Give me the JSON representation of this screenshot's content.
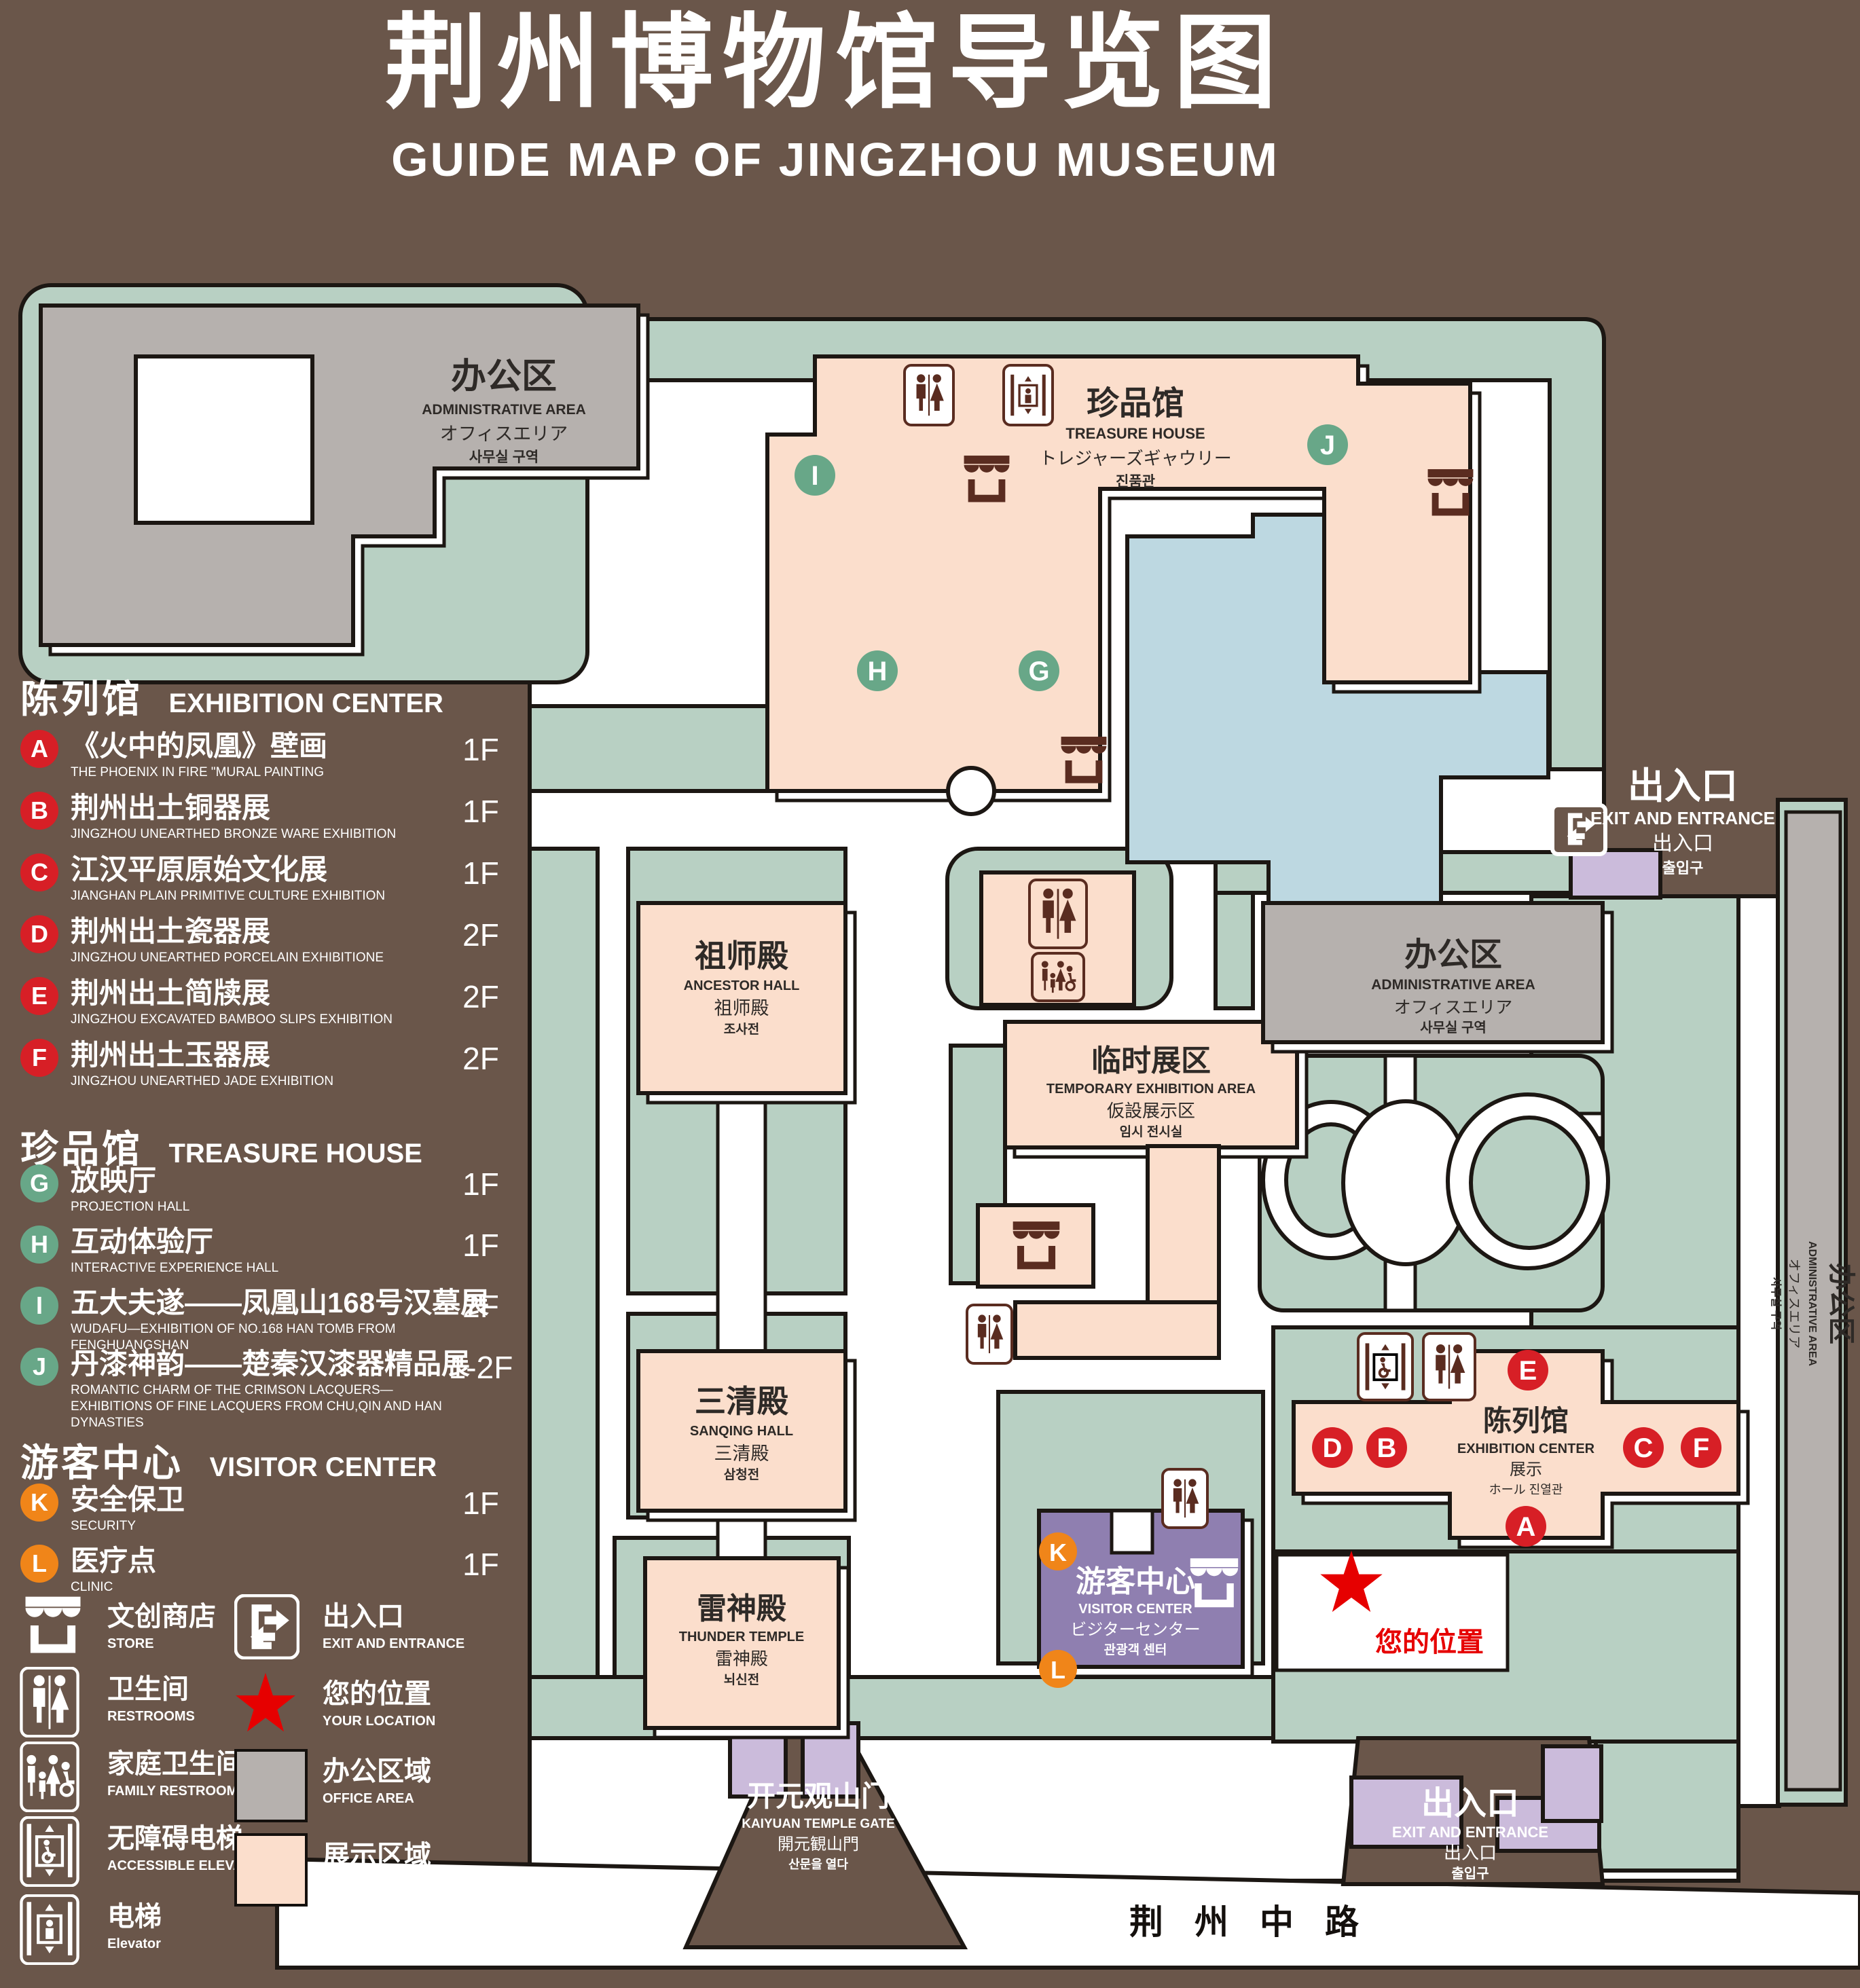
{
  "title": {
    "zh": "荆州博物馆导览图",
    "en": "GUIDE MAP OF JINGZHOU MUSEUM"
  },
  "legend": {
    "sections": [
      {
        "zh": "陈列馆",
        "en": "EXHIBITION CENTER",
        "items": [
          {
            "key": "A",
            "zh": "《火中的凤凰》壁画",
            "en": "THE PHOENIX IN FIRE \"MURAL PAINTING",
            "floor": "1F"
          },
          {
            "key": "B",
            "zh": "荆州出土铜器展",
            "en": "JINGZHOU UNEARTHED BRONZE WARE EXHIBITION",
            "floor": "1F"
          },
          {
            "key": "C",
            "zh": "江汉平原原始文化展",
            "en": "JIANGHAN PLAIN PRIMITIVE CULTURE EXHIBITION",
            "floor": "1F"
          },
          {
            "key": "D",
            "zh": "荆州出土瓷器展",
            "en": "JINGZHOU UNEARTHED PORCELAIN EXHIBITIONE",
            "floor": "2F"
          },
          {
            "key": "E",
            "zh": "荆州出土简牍展",
            "en": "JINGZHOU EXCAVATED BAMBOO SLIPS EXHIBITION",
            "floor": "2F"
          },
          {
            "key": "F",
            "zh": "荆州出土玉器展",
            "en": "JINGZHOU UNEARTHED JADE EXHIBITION",
            "floor": "2F"
          }
        ]
      },
      {
        "zh": "珍品馆",
        "en": "TREASURE HOUSE",
        "items": [
          {
            "key": "G",
            "zh": "放映厅",
            "en": "PROJECTION HALL",
            "floor": "1F"
          },
          {
            "key": "H",
            "zh": "互动体验厅",
            "en": "INTERACTIVE EXPERIENCE HALL",
            "floor": "1F"
          },
          {
            "key": "I",
            "zh": "五大夫遂——凤凰山168号汉墓展",
            "en": "WUDAFU—EXHIBITION OF NO.168 HAN TOMB FROM FENGHUANGSHAN",
            "floor": "2F"
          },
          {
            "key": "J",
            "zh": "丹漆神韵——楚秦汉漆器精品展",
            "en": "ROMANTIC CHARM OF THE CRIMSON LACQUERS—EXHIBITIONS OF FINE LACQUERS FROM CHU,QIN AND HAN DYNASTIES",
            "floor": "1-2F"
          }
        ]
      },
      {
        "zh": "游客中心",
        "en": "VISITOR CENTER",
        "items": [
          {
            "key": "K",
            "zh": "安全保卫",
            "en": "SECURITY",
            "floor": "1F"
          },
          {
            "key": "L",
            "zh": "医疗点",
            "en": "CLINIC",
            "floor": "1F"
          }
        ]
      }
    ],
    "symbols": [
      {
        "zh": "文创商店",
        "en": "STORE"
      },
      {
        "zh": "卫生间",
        "en": "RESTROOMS"
      },
      {
        "zh": "家庭卫生间",
        "en": "FAMILY RESTROOMS"
      },
      {
        "zh": "无障碍电梯",
        "en": "ACCESSIBLE ELEVATOR"
      },
      {
        "zh": "电梯",
        "en": "Elevator"
      },
      {
        "zh": "出入口",
        "en": "EXIT AND ENTRANCE"
      },
      {
        "zh": "您的位置",
        "en": "YOUR LOCATION"
      },
      {
        "zh": "办公区域",
        "en": "OFFICE AREA"
      },
      {
        "zh": "展示区域",
        "en": "DISPLAY AREA"
      }
    ]
  },
  "map": {
    "admin_tl": {
      "zh": "办公区",
      "en": "ADMINISTRATIVE AREA",
      "ja": "オフィスエリア",
      "ko": "사무실 구역"
    },
    "treasure": {
      "zh": "珍品馆",
      "en": "TREASURE HOUSE",
      "ja": "トレジャーズギャウリー",
      "ko": "진품관"
    },
    "ancestor": {
      "zh": "祖师殿",
      "en": "ANCESTOR HALL",
      "ja": "祖师殿",
      "ko": "조사전"
    },
    "temp": {
      "zh": "临时展区",
      "en": "TEMPORARY EXHIBITION AREA",
      "ja": "仮設展示区",
      "ko": "임시 전시실"
    },
    "sanqing": {
      "zh": "三清殿",
      "en": "SANQING HALL",
      "ja": "三清殿",
      "ko": "삼청전"
    },
    "thunder": {
      "zh": "雷神殿",
      "en": "THUNDER TEMPLE",
      "ja": "雷神殿",
      "ko": "뇌신전"
    },
    "visitor": {
      "zh": "游客中心",
      "en": "VISITOR CENTER",
      "ja": "ビジターセンター",
      "ko": "관광객 센터"
    },
    "admin_r": {
      "zh": "办公区",
      "en": "ADMINISTRATIVE AREA",
      "ja": "オフィスエリア",
      "ko": "사무실 구역"
    },
    "admin_strip": {
      "zh": "办公区",
      "en": "ADMINISTRATIVE AREA",
      "ja": "オフィスエリア",
      "ko": "사무실 구역"
    },
    "exhibition": {
      "zh": "陈列馆",
      "en": "EXHIBITION CENTER",
      "zh2": "展示",
      "mix": "ホール 진열관"
    },
    "exit_right": {
      "zh": "出入口",
      "en": "EXIT AND ENTRANCE",
      "zh2": "出入口",
      "ko": "출입구"
    },
    "exit_bottom": {
      "zh": "出入口",
      "en": "EXIT AND ENTRANCE",
      "zh2": "出入口",
      "ko": "출입구"
    },
    "gate": {
      "zh": "开元观山门",
      "en": "KAIYUAN TEMPLE GATE",
      "ja": "開元観山門",
      "ko": "산문을 열다"
    },
    "road": {
      "zh": "荆州中路"
    },
    "location": {
      "zh": "您的位置"
    },
    "markers": {
      "A": "A",
      "B": "B",
      "C": "C",
      "D": "D",
      "E": "E",
      "F": "F",
      "G": "G",
      "H": "H",
      "I": "I",
      "J": "J",
      "K": "K",
      "L": "L"
    }
  },
  "colors": {
    "background": "#6A564A",
    "green": "#B8D0C3",
    "display_pink": "#FBDECC",
    "office_gray": "#B6B1AE",
    "pond_blue": "#BDD8E1",
    "visitor_purple": "#8F7FB0",
    "light_purple": "#CBBBDB",
    "marker_red": "#D71F26",
    "marker_green": "#68A788",
    "marker_orange": "#F08519",
    "icon_brown": "#5A2C20",
    "star_red": "#E60000"
  }
}
